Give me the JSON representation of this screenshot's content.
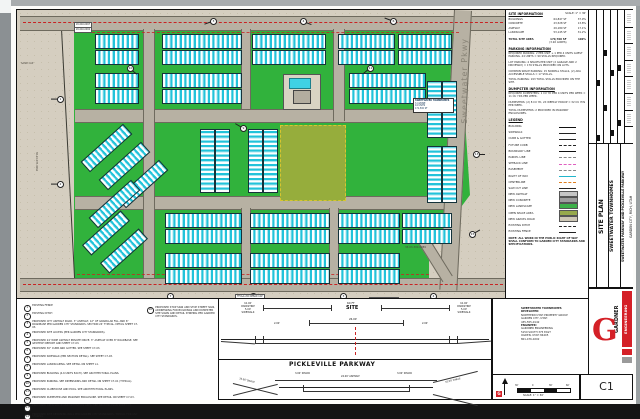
{
  "titleblock": {
    "sheet_title": "SITE PLAN",
    "project": "SWEETWATER TOWNHOMES",
    "location_line": "SWEETWATER PARKWAY AND PICKLEVILLE PARKWAY",
    "city_line": "GARDEN CITY, RICH, UTAH",
    "sheet_number": "C1"
  },
  "logo": {
    "word1": "GARDNER",
    "word2": "ENGINEERING",
    "mark": "G"
  },
  "scale_bar": {
    "ticks": [
      "30'",
      "0",
      "30'",
      "60'"
    ],
    "caption": "SCALE: 1\" = 30'"
  },
  "contact_block": {
    "lines": [
      "SWEETWATER TOWNHOMES",
      "DEVELOPER:",
      "NORTHERN UTAH PROPERTY GROUP",
      "GARDEN CITY, UTAH",
      "435-555-0142",
      "ENGINEER:",
      "GARDNER ENGINEERING",
      "5150 SOUTH 375 EAST",
      "OGDEN, UTAH 84405",
      "801-476-0202"
    ]
  },
  "site_info": {
    "title": "SITE INFORMATION",
    "scale_note": "SCALE: 1\" = 30'",
    "rows": [
      {
        "label": "BUILDINGS",
        "area": "64,847 SF",
        "pct": "37.9%"
      },
      {
        "label": "CONCRETE",
        "area": "23,528 SF",
        "pct": "13.8%"
      },
      {
        "label": "ASPHALT",
        "area": "29,180 SF",
        "pct": "17.1%"
      },
      {
        "label": "LANDSCAPE",
        "area": "53,145 SF",
        "pct": "31.2%"
      }
    ],
    "total": {
      "label": "TOTAL SITE AREA",
      "area": "170,700 SF",
      "sub": "(3.92 ACRES)",
      "pct": "100%"
    }
  },
  "parking_info": {
    "title": "PARKING INFORMATION",
    "paragraphs": [
      "REQUIRED PARKING: 2 PER UNIT + 1 PER 4 UNITS GUEST PARKING. 44 UNITS = 99 STALLS REQUIRED.",
      "LOT PARKING: 4 SPACES PER UNIT (2 GARAGE AND 2 DRIVEWAY) = 176 STALLS PROVIDED ON LOTS.",
      "COMMON SPACE PARKING: 15 NORMAL STALLS, (2) ADA ACCESSIBLE STALLS = 17 STALLS.",
      "TOTAL PARKING: 193 TOTAL STALLS PROVIDED ON THE SITE."
    ]
  },
  "dumpster_info": {
    "title": "DUMPSTER INFORMATION",
    "paragraphs": [
      "REQUIRED DUMPSTERS: 1 CU YD PER 4 UNITS PER WEEK = 11 CU YDS PER WEEK.",
      "DUMPSTERS: (2) 8 CU YD, 2X WEEKLY PICKUP = 32 CU YDS PER WEEK.",
      "TOTAL DUMPSTERS: 2 PROVIDED IN MASONRY ENCLOSURES."
    ]
  },
  "legend": {
    "title": "LEGEND",
    "items": [
      {
        "label": "BUILDING",
        "style": "thick"
      },
      {
        "label": "SIDEWALK",
        "style": "line"
      },
      {
        "label": "CURB & GUTTER",
        "style": "line"
      },
      {
        "label": "FUTURE CURB",
        "style": "dash"
      },
      {
        "label": "BOUNDARY LINE",
        "style": "thick"
      },
      {
        "label": "PARCEL LINE",
        "style": "dashgray"
      },
      {
        "label": "SETBACK LINE",
        "style": "pink"
      },
      {
        "label": "EASEMENT",
        "style": "dashgray"
      },
      {
        "label": "RIGHT OF WAY",
        "style": "cyan"
      },
      {
        "label": "CENTERLINE",
        "style": "orange"
      },
      {
        "label": "SAW CUT LINE",
        "style": "line"
      },
      {
        "label": "NEW ASPHALT",
        "style": "swatch",
        "color": "#c6c6c6"
      },
      {
        "label": "NEW CONCRETE",
        "style": "swatch",
        "color": "#9e9e9e"
      },
      {
        "label": "NEW LANDSCAPE",
        "style": "swatch",
        "color": "#3db049"
      },
      {
        "label": "OPEN SPACE AREA",
        "style": "swatch",
        "color": "#97a94c"
      },
      {
        "label": "NEW GRAVEL ROAD",
        "style": "swatch",
        "color": "#cdc6b4"
      },
      {
        "label": "EXISTING DITCH",
        "style": "dash"
      },
      {
        "label": "EXISTING FENCE",
        "style": "fence"
      }
    ]
  },
  "general_note": "NOTE: ALL WORK IN THE PUBLIC RIGHT OF WAY SHALL CONFORM TO GARDEN CITY STANDARDS AND SPECIFICATIONS.",
  "keyed_notes": {
    "items": [
      {
        "n": "1",
        "text": "EXISTING FENCE"
      },
      {
        "n": "2",
        "text": "EXISTING DITCH"
      },
      {
        "n": "3",
        "text": "PROPOSED CITY ASPHALT ROAD. 3\" ASPHALT, 12\" OF GRANULAR FILL AND 6\" ROADBASE PER GARDEN CITY STANDARDS. SECTION 24' TYPICAL. DETAIL SHEET C7-03."
      },
      {
        "n": "4",
        "text": "PROPOSED SITE ACCESS (PER GARDEN CITY STANDARDS)."
      },
      {
        "n": "5",
        "text": "PROPOSED 24' WIDE ASPHALT PRIVATE DRIVE. 3\" ASPHALT OVER 8\" ROADBASE. SEE GEOTECH REPORT AND SHEET C7-03."
      },
      {
        "n": "6",
        "text": "PROPOSED 30\" CURB AND GUTTER. SEE SHEET C7-03."
      },
      {
        "n": "7",
        "text": "PROPOSED SIDEWALK (PER SECTION DETAIL). SEE SHEET C7-03."
      },
      {
        "n": "8",
        "text": "PROPOSED LANDSCAPING. SEE DETAIL ON SHEET L1."
      },
      {
        "n": "9",
        "text": "PROPOSED BUILDING (4-6 UNITS EACH). SEE ARCHITECTURAL PLANS."
      },
      {
        "n": "10",
        "text": "PROPOSED PARKING. SEE DIMENSIONS AND DETAIL ON SHEET C7-01 (TYPICAL)."
      },
      {
        "n": "11",
        "text": "PROPOSED CLUBHOUSE AND POOL. SEE ARCHITECTURAL PLANS."
      },
      {
        "n": "12",
        "text": "PROPOSED DUMPSTER AND MASONRY ENCLOSURE. SEE DETAIL ON SHEET C7-03."
      },
      {
        "n": "13",
        "text": "PROPOSED OPEN SPACE AND DETENTION AREA. SEE GRADING PLAN SHEET C3."
      },
      {
        "n": "14",
        "text": "PROPOSED SITE RETAINING WALL PER GARDEN CITY STANDARDS. TYPICAL FOR ANY STAKING."
      },
      {
        "n": "15",
        "text": "PROPOSED 10' LANDSCAPE BUFFER AROUND SITE PERIMETER (TYPICAL)."
      }
    ],
    "side_note": {
      "n": "16",
      "text": "PROPOSED STOP SIGN AND STOP STREET SIGN, ADDRESSING FOR BUILDINGS AND DUMPSTER SITE SIGNS AND DETAIL STRIPING PER GARDEN CITY STANDARDS."
    }
  },
  "section_panel": {
    "top": {
      "parkstrip_lines": [
        "10.00'",
        "PARKSTRIP",
        "5.00'",
        "SIDEWALK"
      ],
      "width_label": "60 FT",
      "site_label": "SITE",
      "center_dim": "26.00'",
      "edge_dim": "2.00'"
    },
    "bottom": {
      "title": "PICKLEVILLE PARKWAY",
      "shoulder": "3.00' SHLDR",
      "asphalt": "24.00' ASPHALT",
      "swale": "10.00' SWALE"
    }
  },
  "plan": {
    "road_label": "Sweetwater Pkwy",
    "info_box_lines": [
      "SWEETWATER TOWNHOMES",
      "3.4 ZONE",
      "44 UNITS",
      "171,500 SF"
    ],
    "labels": [
      {
        "x": 4,
        "y": 52,
        "s": 2.4,
        "text": "SAND CAP"
      },
      {
        "x": 10,
        "y": 150,
        "r": 90,
        "s": 2.4,
        "text": "38-20-035-0062"
      },
      {
        "x": 388,
        "y": 236,
        "s": 2.6,
        "text": "38-03-300-0089"
      },
      {
        "x": 57,
        "y": 12,
        "s": 2.2,
        "text": "20-040-0067",
        "bg": 1
      },
      {
        "x": 57,
        "y": 17,
        "s": 2.2,
        "text": "20-040-0062",
        "bg": 1
      },
      {
        "x": 218,
        "y": 284,
        "s": 2.2,
        "text": "TFC&G 200 REBAR CAP",
        "bg": 1
      },
      {
        "x": 352,
        "y": 287,
        "s": 2.2,
        "text": "TFC&G 200 REBAR CAP",
        "bg": 1
      }
    ],
    "green_polygon": [
      [
        57,
        19
      ],
      [
        442,
        19
      ],
      [
        453,
        185
      ],
      [
        412,
        240
      ],
      [
        412,
        268
      ],
      [
        57,
        268
      ]
    ],
    "roads_h": [
      [
        3,
        6,
        485,
        13
      ],
      [
        3,
        268,
        485,
        12
      ],
      [
        58,
        99,
        385,
        12
      ],
      [
        58,
        186,
        385,
        12
      ]
    ],
    "roads_v": [
      [
        126,
        19,
        10,
        249
      ],
      [
        316,
        19,
        10,
        92
      ],
      [
        224,
        19,
        8,
        80
      ],
      [
        224,
        198,
        8,
        70
      ],
      [
        312,
        198,
        8,
        70
      ]
    ],
    "roads_diag": [
      [
        437,
        0,
        16,
        280,
        3
      ],
      [
        398,
        228,
        10,
        52,
        -32
      ]
    ],
    "centerlines": [
      [
        6,
        12,
        480
      ],
      [
        6,
        274,
        480
      ]
    ],
    "setbacks": [
      [
        60,
        22,
        382
      ],
      [
        60,
        264,
        352
      ]
    ],
    "buildings": [
      [
        78,
        24,
        42,
        13
      ],
      [
        145,
        24,
        78,
        13
      ],
      [
        235,
        24,
        72,
        13
      ],
      [
        321,
        24,
        55,
        13
      ],
      [
        381,
        24,
        52,
        13
      ],
      [
        78,
        40,
        42,
        13
      ],
      [
        145,
        40,
        78,
        13
      ],
      [
        235,
        40,
        72,
        13
      ],
      [
        321,
        40,
        55,
        13
      ],
      [
        381,
        40,
        52,
        13
      ],
      [
        78,
        63,
        42,
        13
      ],
      [
        145,
        63,
        78,
        13
      ],
      [
        78,
        79,
        42,
        13
      ],
      [
        145,
        79,
        78,
        13
      ],
      [
        332,
        63,
        75,
        13
      ],
      [
        332,
        79,
        75,
        13
      ],
      [
        410,
        71,
        13,
        55
      ],
      [
        425,
        71,
        13,
        55
      ],
      [
        410,
        136,
        13,
        55
      ],
      [
        425,
        136,
        13,
        55
      ],
      [
        183,
        119,
        13,
        62
      ],
      [
        198,
        119,
        13,
        62
      ],
      [
        231,
        119,
        13,
        62
      ],
      [
        246,
        119,
        13,
        62
      ],
      [
        61,
        131,
        55,
        12,
        -42
      ],
      [
        79,
        149,
        55,
        12,
        -42
      ],
      [
        97,
        167,
        55,
        12,
        -42
      ],
      [
        69,
        187,
        55,
        12,
        -42
      ],
      [
        63,
        216,
        50,
        12,
        -42
      ],
      [
        81,
        234,
        50,
        12,
        -42
      ],
      [
        148,
        203,
        75,
        13
      ],
      [
        233,
        203,
        78,
        13
      ],
      [
        321,
        203,
        60,
        13
      ],
      [
        385,
        203,
        48,
        13
      ],
      [
        148,
        219,
        75,
        13
      ],
      [
        233,
        219,
        78,
        13
      ],
      [
        321,
        219,
        60,
        13
      ],
      [
        385,
        219,
        48,
        13
      ],
      [
        148,
        243,
        75,
        13
      ],
      [
        233,
        243,
        78,
        13
      ],
      [
        321,
        243,
        60,
        13
      ],
      [
        148,
        259,
        75,
        13
      ],
      [
        233,
        259,
        78,
        13
      ],
      [
        321,
        259,
        60,
        13
      ]
    ],
    "callouts": [
      [
        193,
        8,
        "3",
        160
      ],
      [
        283,
        8,
        "4",
        20
      ],
      [
        373,
        8,
        "6",
        200
      ],
      [
        40,
        86,
        "1",
        180
      ],
      [
        40,
        171,
        "2",
        180
      ],
      [
        150,
        283,
        "7",
        90
      ],
      [
        233,
        283,
        "5",
        80
      ],
      [
        323,
        283,
        "3",
        100
      ],
      [
        413,
        283,
        "4",
        70
      ],
      [
        456,
        141,
        "13",
        0
      ],
      [
        452,
        221,
        "15",
        330
      ],
      [
        223,
        115,
        "9",
        210
      ],
      [
        350,
        55,
        "11",
        140
      ],
      [
        110,
        55,
        "10",
        40
      ]
    ],
    "revision_marks": [
      [
        8,
        70
      ],
      [
        15,
        95
      ],
      [
        22,
        60
      ],
      [
        29,
        110
      ],
      [
        22,
        120
      ],
      [
        8,
        125
      ],
      [
        15,
        40
      ],
      [
        29,
        55
      ]
    ]
  }
}
